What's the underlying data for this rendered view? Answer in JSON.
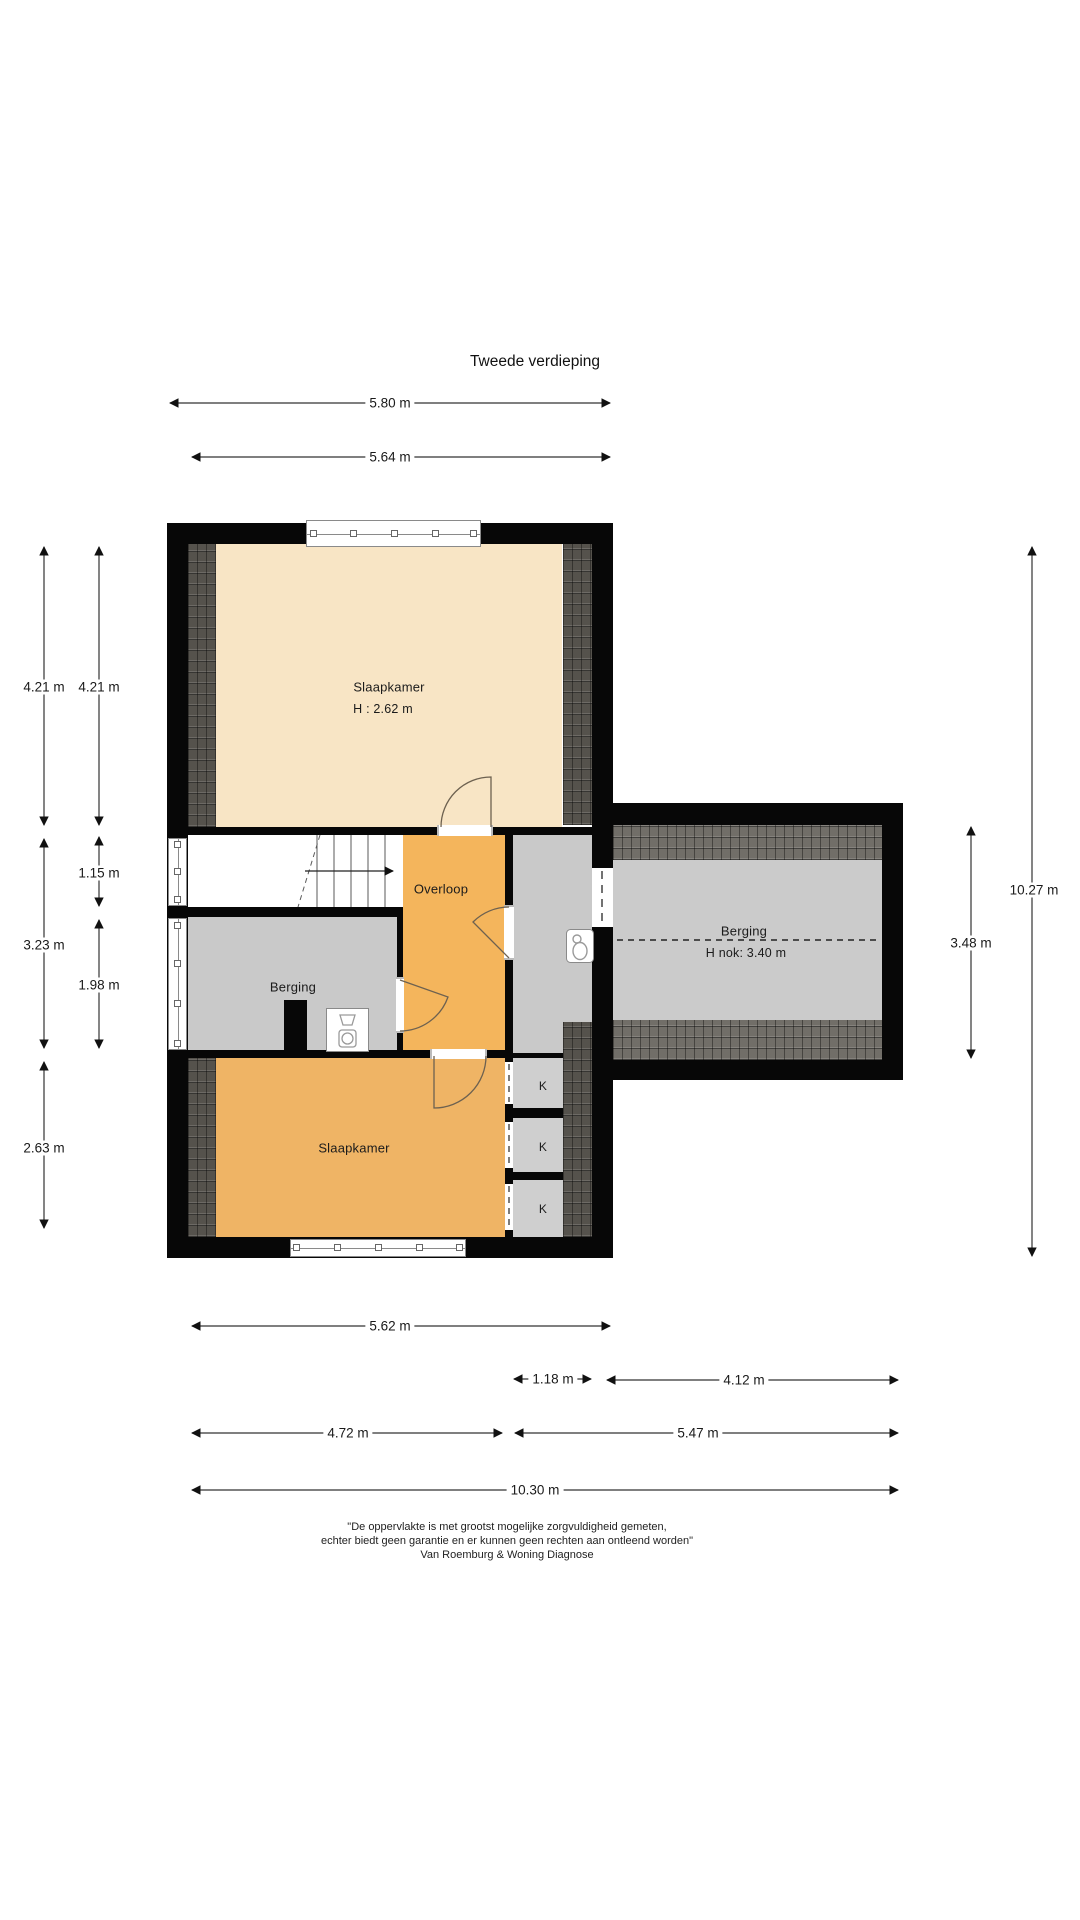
{
  "title": "Tweede verdieping",
  "rooms": {
    "slaapkamer1": {
      "label": "Slaapkamer",
      "height_label": "H : 2.62 m"
    },
    "overloop": {
      "label": "Overloop"
    },
    "berging_left": {
      "label": "Berging"
    },
    "slaapkamer2": {
      "label": "Slaapkamer"
    },
    "berging_right": {
      "label": "Berging",
      "ridge_height_label": "H nok: 3.40 m"
    },
    "closet": {
      "label": "K"
    }
  },
  "dimensions": {
    "top": [
      "5.80 m",
      "5.64 m"
    ],
    "left": [
      "4.21 m",
      "4.21 m",
      "1.15 m",
      "3.23 m",
      "1.98 m",
      "2.63 m"
    ],
    "right": [
      "3.48 m",
      "10.27 m"
    ],
    "bottom": [
      "5.62 m",
      "1.18 m",
      "4.12 m",
      "4.72 m",
      "5.47 m",
      "10.30 m"
    ]
  },
  "footer": {
    "line1": "\"De oppervlakte is met grootst mogelijke zorgvuldigheid gemeten,",
    "line2": "echter biedt geen garantie en er kunnen geen rechten aan ontleend worden\"",
    "line3": "Van Roemburg & Woning Diagnose"
  },
  "icons": {
    "toilet": "toilet-icon",
    "laundry": "washing-machine-icon",
    "stairs_direction": "arrow-right-icon"
  },
  "colors": {
    "wall": "#070707",
    "bedroom_top_floor": "#F8E5C5",
    "landing_floor": "#F4B55C",
    "bedroom_bottom_floor": "#EFB465",
    "storage_floor": "#C9C9C9",
    "closet_floor": "#CFCFCF",
    "roof_hatch_dark": "#55524C",
    "roof_hatch_light": "#716E68"
  }
}
